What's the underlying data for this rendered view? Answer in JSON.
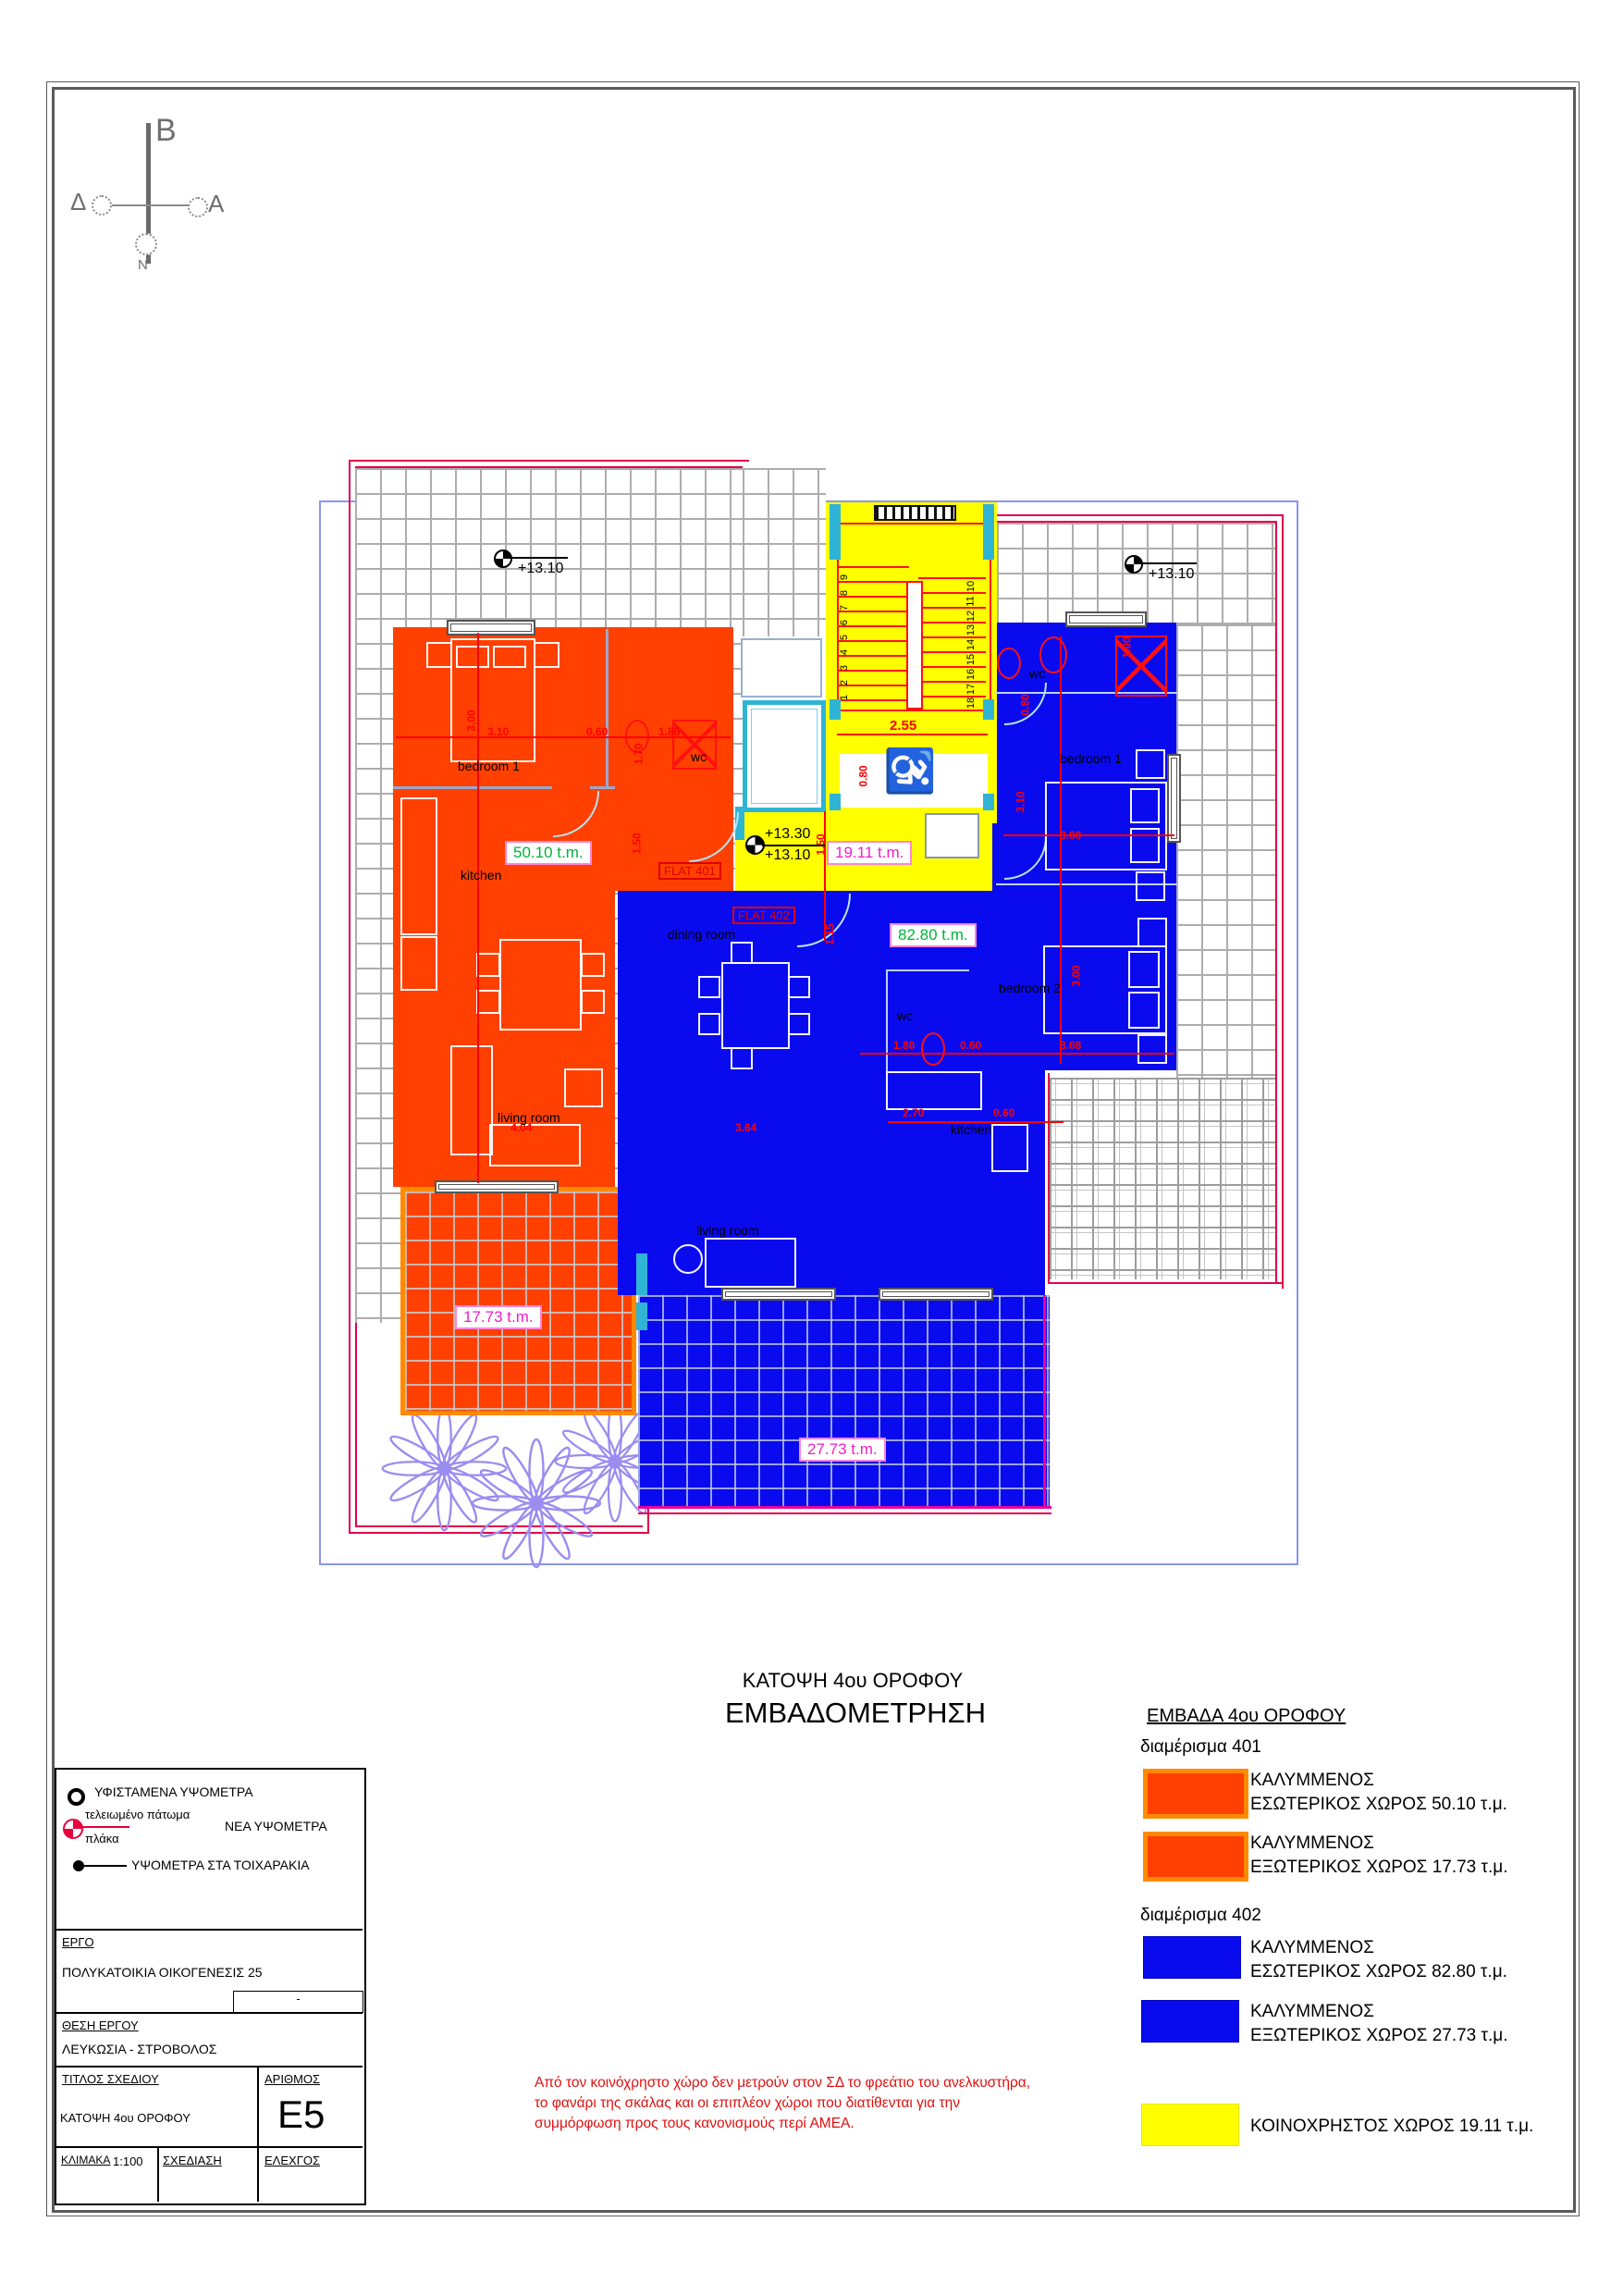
{
  "compass": {
    "north": "B",
    "west": "Δ",
    "east": "A",
    "south": "N"
  },
  "plan": {
    "benchmarks": {
      "top_left": "+13.10",
      "top_right": "+13.10",
      "mid_top": "+13.30",
      "mid_bottom": "+13.10"
    },
    "flat_labels": {
      "f401": "FLAT 401",
      "f402": "FLAT 402"
    },
    "area_labels": {
      "f401_interior": "50.10 t.m.",
      "f402_interior": "82.80 t.m.",
      "common": "19.11 t.m.",
      "f401_veranda": "17.73 t.m.",
      "f402_veranda": "27.73 t.m."
    },
    "rooms": {
      "f401_bedroom": "bedroom 1",
      "f401_kitchen": "kitchen",
      "f401_living": "living room",
      "f401_wc": "wc",
      "f402_wc_top": "wc",
      "f402_bedroom1": "bedroom 1",
      "f402_bedroom2": "bedroom 2",
      "f402_wc": "wc",
      "f402_kitchen": "kitchen",
      "f402_dining": "dining room",
      "f402_living": "living room"
    },
    "dims": {
      "d1": "3.00",
      "d2": "3.10",
      "d3": "0.60",
      "d4": "1.86",
      "d5": "1.70",
      "d6": "1.50",
      "d7": "1.50",
      "d8": "1.15",
      "d9": "2.55",
      "d10": "0.80",
      "d11": "1.00",
      "d12": "0.80",
      "d13": "3.10",
      "d14": "3.00",
      "d15": "3.00",
      "d16": "3.08",
      "d17": "0.60",
      "d18": "1.80",
      "d19": "2.70",
      "d20": "0.60",
      "d21": "4.04",
      "d22": "3.64"
    },
    "stairs": [
      "1",
      "2",
      "3",
      "4",
      "5",
      "6",
      "7",
      "8",
      "9",
      "10",
      "11",
      "12",
      "13",
      "14",
      "15",
      "16",
      "17",
      "18"
    ]
  },
  "titles": {
    "line1": "ΚΑΤΟΨΗ  4ου ΟΡΟΦΟΥ",
    "line2": "ΕΜΒΑΔΟΜΕΤΡΗΣΗ"
  },
  "legend": {
    "title": "ΕΜΒΑΔΑ 4ου ΟΡΟΦΟΥ",
    "apt401": "διαμέρισμα 401",
    "apt402": "διαμέρισμα 402",
    "covered": "ΚΑΛΥΜΜΕΝΟΣ",
    "r1": "ΕΣΩΤΕΡΙΚΟΣ ΧΩΡΟΣ  50.10 τ.μ.",
    "r2": "ΕΞΩΤΕΡΙΚΟΣ ΧΩΡΟΣ  17.73 τ.μ.",
    "r3": "ΕΣΩΤΕΡΙΚΟΣ ΧΩΡΟΣ  82.80 τ.μ.",
    "r4": "ΕΞΩΤΕΡΙΚΟΣ ΧΩΡΟΣ  27.73 τ.μ.",
    "r5": "ΚΟΙΝΟΧΡΗΣΤΟΣ ΧΩΡΟΣ  19.11 τ.μ.",
    "colors": {
      "orange": "#FF4000",
      "orange_border": "#FF8A00",
      "blue": "#0A0AEE",
      "yellow": "#FFFF00",
      "teal": "#2FB4D6",
      "boundary_red": "#E0004C"
    }
  },
  "note": {
    "line1": "Από τον κοινόχρηστο χώρο δεν μετρούν στον ΣΔ το φρεάτιο του ανελκυστήρα,",
    "line2": "το φανάρι της σκάλας και οι επιπλέον χώροι που διατίθενται για την",
    "line3": "συμμόρφωση προς τους κανονισμούς περί ΑΜΕΑ."
  },
  "symbols": {
    "existing": "ΥΦΙΣΤΑΜΕΝΑ ΥΨΟΜΕΤΡΑ",
    "finished_floor": "τελειωμένο πάτωμα",
    "slab": "πλάκα",
    "new": "ΝΕΑ ΥΨΟΜΕΤΡΑ",
    "walls": "ΥΨΟΜΕΤΡΑ ΣΤΑ ΤΟΙΧΑΡΑΚΙΑ"
  },
  "titleblock": {
    "ergo_label": "ΕΡΓΟ",
    "ergo_value": "ΠΟΛΥΚΑΤΟΙΚΙΑ ΟΙΚΟΓΕΝΕΣΙΣ 25",
    "rev": "-",
    "thesi_label": "ΘΕΣΗ ΕΡΓΟΥ",
    "thesi_value": "ΛΕΥΚΩΣΙΑ - ΣΤΡΟΒΟΛΟΣ",
    "titlos_label": "ΤΙΤΛΟΣ ΣΧΕΔΙΟΥ",
    "titlos_value": "ΚΑΤΟΨΗ 4ου ΟΡΟΦΟΥ",
    "arithmos_label": "ΑΡΙΘΜΟΣ",
    "arithmos_value": "E5",
    "klimaka_label": "ΚΛΙΜΑΚΑ",
    "klimaka_value": "1:100",
    "sxediasi_label": "ΣΧΕΔΙΑΣΗ",
    "elegxos_label": "ΕΛΕΧΓΟΣ"
  }
}
